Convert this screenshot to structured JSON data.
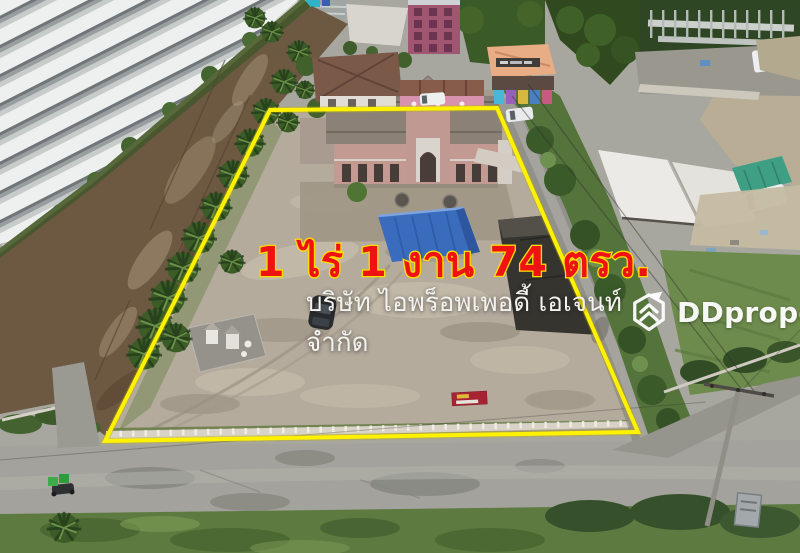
{
  "photo": {
    "type": "aerial-drone-photo",
    "subject": "vacant land plot with two-storey building, blue canopy, palm trees, shrine, roads, housing estate and construction site",
    "boundary_color": "#fff200"
  },
  "overlay": {
    "area_label": "1 ไร่ 1 งาน 74 ตรว.",
    "company_line1": "บริษัท ไอพร็อพเพอดี้ เอเจนท์",
    "company_line2": "จำกัด",
    "area_label_color": "#ef1212",
    "area_label_outline_color": "#ffdf00",
    "company_text_color": "#ffffff"
  },
  "watermark": {
    "brand": "DDproperty",
    "icon": "ddproperty-hexagon-chevron-icon",
    "color": "#ffffff"
  }
}
